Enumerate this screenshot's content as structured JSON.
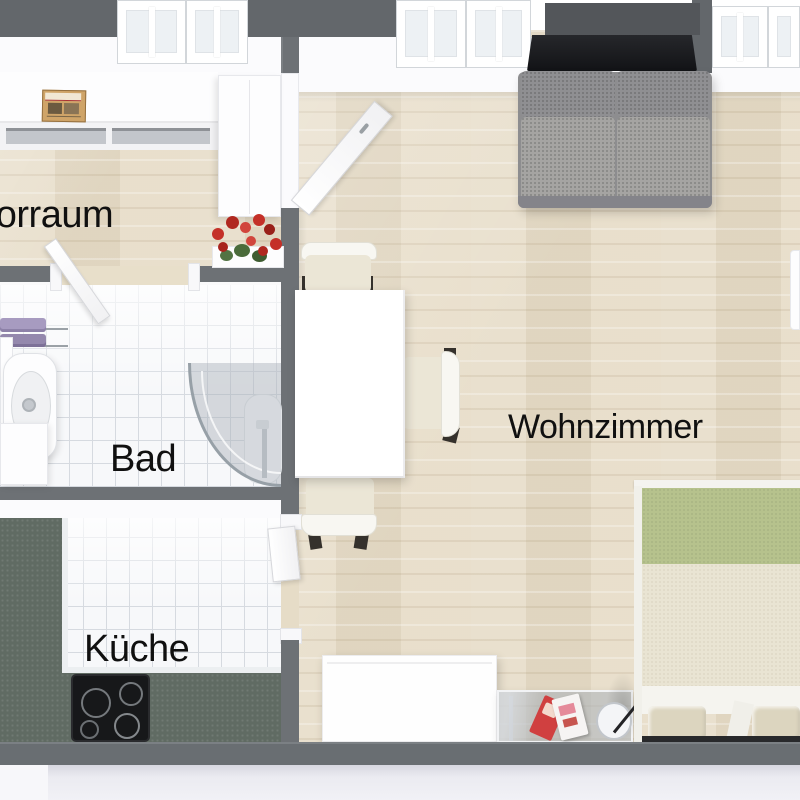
{
  "floorplan": {
    "view": "3D top-down apartment floor plan",
    "rooms": [
      {
        "id": "vorraum",
        "label": "Vorraum",
        "floor": "wood"
      },
      {
        "id": "bad",
        "label": "Bad",
        "floor": "white-tile"
      },
      {
        "id": "kueche",
        "label": "Küche",
        "floor": "white-tile-with-green-counter"
      },
      {
        "id": "wohnzimmer",
        "label": "Wohnzimmer",
        "floor": "light-wood"
      }
    ],
    "furniture_icons": [
      "hall-sideboard",
      "newspaper",
      "wardrobe",
      "flower-pot",
      "towel-rail",
      "bathroom-sink",
      "washing-machine",
      "corner-shower",
      "kitchen-counter",
      "stove-cooktop",
      "kitchen-door",
      "dining-table",
      "dining-chair",
      "sofa",
      "tv-screen",
      "tv-board",
      "living-sideboard",
      "coffee-table",
      "magazine",
      "arc-floor-lamp",
      "double-bed",
      "pillows",
      "window",
      "door-panel"
    ],
    "colors": {
      "wall_gray": "#6d7175",
      "wall_outer_gray": "#63676b",
      "wood_floor_beige": "#e7ddc8",
      "tile_white": "#f7f8fa",
      "kitchen_counter_green": "#606b63",
      "sofa_gray": "#a2a19f",
      "tv_black": "#191a1d",
      "bed_blanket_green": "#b6c28d",
      "bed_duvet_cream": "#e9e4d3",
      "flower_red": "#c43028",
      "towel_purple": "#9e92b6",
      "label_black": "#101010"
    }
  }
}
